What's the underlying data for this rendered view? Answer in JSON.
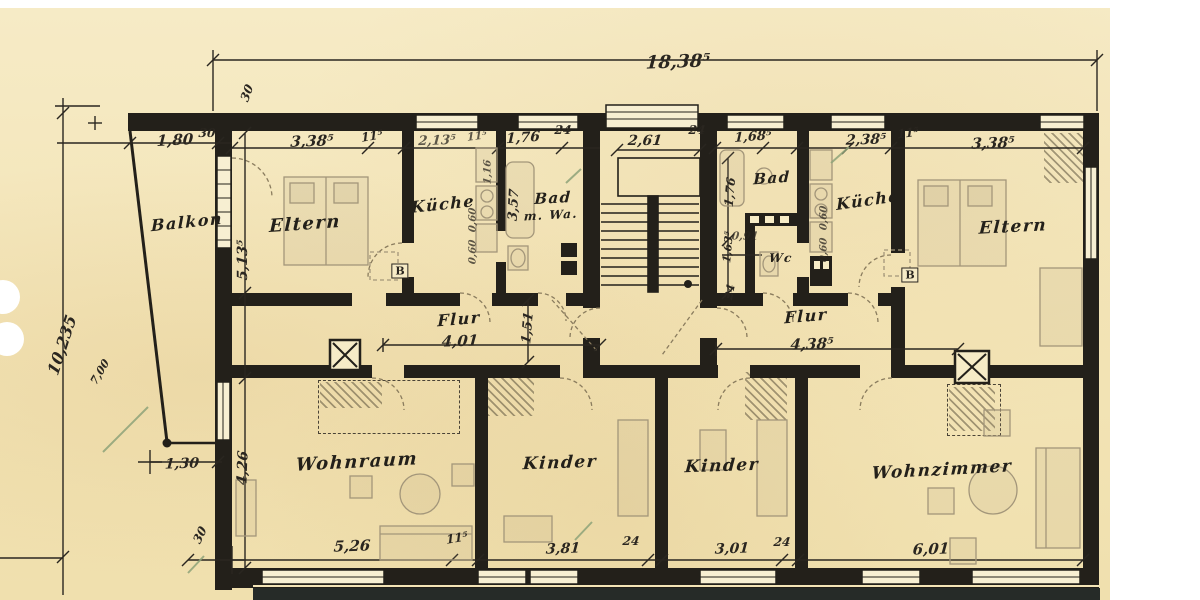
{
  "document": {
    "kind": "scanned architectural floor plan",
    "paper_color": "#f3e4b6",
    "ink_color": "#23201a",
    "pencil_color": "#a3967a",
    "checkmark_color": "#8ea379"
  },
  "overall_width_dimension": "18,38⁵",
  "rooms": [
    {
      "label": "Balkon",
      "x": 187,
      "y": 222,
      "rot": -6,
      "size": 16
    },
    {
      "label": "Eltern",
      "x": 305,
      "y": 224,
      "rot": -4,
      "size": 18
    },
    {
      "label": "Küche",
      "x": 443,
      "y": 204,
      "rot": -6,
      "size": 16
    },
    {
      "label": "Bad",
      "x": 553,
      "y": 198,
      "rot": -3,
      "size": 15
    },
    {
      "label": "m. Wa.",
      "x": 551,
      "y": 215,
      "rot": -3,
      "size": 12
    },
    {
      "label": "Flur",
      "x": 459,
      "y": 319,
      "rot": -5,
      "size": 16
    },
    {
      "label": "Bad",
      "x": 772,
      "y": 178,
      "rot": -4,
      "size": 15
    },
    {
      "label": "Wc",
      "x": 781,
      "y": 258,
      "rot": 0,
      "size": 12
    },
    {
      "label": "Küche",
      "x": 868,
      "y": 200,
      "rot": -8,
      "size": 16
    },
    {
      "label": "Eltern",
      "x": 1013,
      "y": 227,
      "rot": -3,
      "size": 17
    },
    {
      "label": "Flur",
      "x": 806,
      "y": 316,
      "rot": -5,
      "size": 16
    },
    {
      "label": "Wohnraum",
      "x": 357,
      "y": 462,
      "rot": -3,
      "size": 18
    },
    {
      "label": "Kinder",
      "x": 560,
      "y": 463,
      "rot": -2,
      "size": 17
    },
    {
      "label": "Kinder",
      "x": 722,
      "y": 466,
      "rot": -2,
      "size": 17
    },
    {
      "label": "Wohnzimmer",
      "x": 942,
      "y": 470,
      "rot": -3,
      "size": 17
    }
  ],
  "dimensions": [
    {
      "text": "18,38⁵",
      "x": 678,
      "y": 62,
      "size": 18,
      "rot": -2
    },
    {
      "text": "30",
      "x": 207,
      "y": 133,
      "size": 12,
      "rot": 0
    },
    {
      "text": "1,80",
      "x": 175,
      "y": 140,
      "size": 15,
      "rot": -3
    },
    {
      "text": "3,38⁵",
      "x": 312,
      "y": 141,
      "size": 15,
      "rot": -2
    },
    {
      "text": "11⁵",
      "x": 372,
      "y": 136,
      "size": 12,
      "rot": -10
    },
    {
      "text": "2,13⁵",
      "x": 437,
      "y": 141,
      "size": 13,
      "rot": -2,
      "cls": "light"
    },
    {
      "text": "11⁵",
      "x": 477,
      "y": 136,
      "size": 11,
      "rot": -8,
      "cls": "light"
    },
    {
      "text": "1,76",
      "x": 523,
      "y": 138,
      "size": 14,
      "rot": -4
    },
    {
      "text": "24",
      "x": 563,
      "y": 130,
      "size": 12,
      "rot": 0
    },
    {
      "text": "2,61",
      "x": 645,
      "y": 141,
      "size": 14,
      "rot": 0
    },
    {
      "text": "24",
      "x": 697,
      "y": 130,
      "size": 12,
      "rot": 0
    },
    {
      "text": "1,68⁵",
      "x": 753,
      "y": 137,
      "size": 13,
      "rot": -4
    },
    {
      "text": "2,38⁵",
      "x": 866,
      "y": 140,
      "size": 14,
      "rot": -2
    },
    {
      "text": "11⁵",
      "x": 908,
      "y": 133,
      "size": 12,
      "rot": -8
    },
    {
      "text": "3,38⁵",
      "x": 993,
      "y": 143,
      "size": 15,
      "rot": -2
    },
    {
      "text": "30",
      "x": 247,
      "y": 93,
      "size": 12,
      "rot": -70
    },
    {
      "text": "10,235",
      "x": 62,
      "y": 345,
      "size": 16,
      "rot": -72
    },
    {
      "text": "7,00",
      "x": 100,
      "y": 372,
      "size": 11,
      "rot": -60
    },
    {
      "text": "5,13⁵",
      "x": 243,
      "y": 260,
      "size": 14,
      "rot": -90
    },
    {
      "text": "1,16",
      "x": 488,
      "y": 172,
      "size": 10,
      "rot": -90,
      "cls": "light"
    },
    {
      "text": "0,60",
      "x": 473,
      "y": 220,
      "size": 10,
      "rot": -90,
      "cls": "light"
    },
    {
      "text": "0,60",
      "x": 473,
      "y": 252,
      "size": 10,
      "rot": -90,
      "cls": "light"
    },
    {
      "text": "3,57",
      "x": 514,
      "y": 205,
      "size": 13,
      "rot": -87
    },
    {
      "text": "1,51",
      "x": 528,
      "y": 328,
      "size": 13,
      "rot": -85
    },
    {
      "text": "4,01",
      "x": 460,
      "y": 341,
      "size": 15,
      "rot": -2
    },
    {
      "text": "4,38⁵",
      "x": 812,
      "y": 344,
      "size": 15,
      "rot": -2
    },
    {
      "text": "1,76",
      "x": 730,
      "y": 192,
      "size": 12,
      "rot": -85
    },
    {
      "text": "1,63⁵",
      "x": 728,
      "y": 247,
      "size": 11,
      "rot": -85
    },
    {
      "text": "24",
      "x": 730,
      "y": 292,
      "size": 11,
      "rot": -80
    },
    {
      "text": "0,91",
      "x": 745,
      "y": 236,
      "size": 11,
      "rot": 0,
      "cls": "light"
    },
    {
      "text": "0,60",
      "x": 824,
      "y": 218,
      "size": 10,
      "rot": -90,
      "cls": "light"
    },
    {
      "text": "0,60",
      "x": 824,
      "y": 250,
      "size": 10,
      "rot": -90,
      "cls": "light"
    },
    {
      "text": "4,26",
      "x": 243,
      "y": 468,
      "size": 14,
      "rot": -88
    },
    {
      "text": "1,30",
      "x": 182,
      "y": 464,
      "size": 14,
      "rot": -2
    },
    {
      "text": "30",
      "x": 200,
      "y": 535,
      "size": 12,
      "rot": -65
    },
    {
      "text": "5,26",
      "x": 352,
      "y": 546,
      "size": 15,
      "rot": -2
    },
    {
      "text": "11⁵",
      "x": 457,
      "y": 538,
      "size": 12,
      "rot": -10
    },
    {
      "text": "3,81",
      "x": 563,
      "y": 549,
      "size": 14,
      "rot": -2
    },
    {
      "text": "24",
      "x": 631,
      "y": 541,
      "size": 12,
      "rot": 0
    },
    {
      "text": "3,01",
      "x": 732,
      "y": 549,
      "size": 14,
      "rot": -2
    },
    {
      "text": "24",
      "x": 782,
      "y": 542,
      "size": 12,
      "rot": 0
    },
    {
      "text": "6,01",
      "x": 931,
      "y": 549,
      "size": 15,
      "rot": -2
    },
    {
      "text": "B",
      "x": 400,
      "y": 271,
      "size": 11,
      "rot": 0,
      "cls": "boxed"
    },
    {
      "text": "B",
      "x": 910,
      "y": 275,
      "size": 11,
      "rot": 0,
      "cls": "boxed"
    }
  ]
}
